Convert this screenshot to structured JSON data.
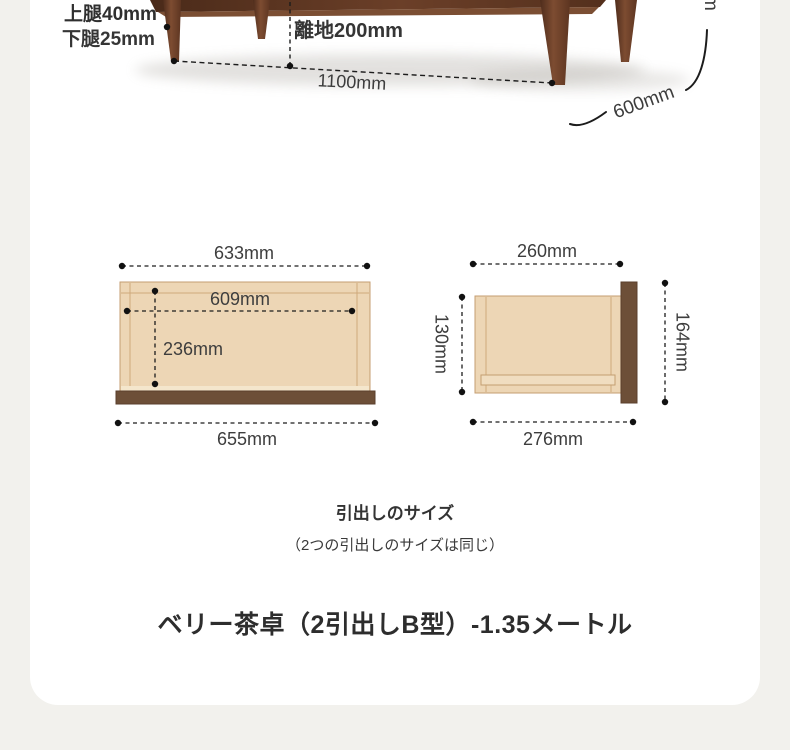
{
  "photo": {
    "upper_leg_label": "上腿40mm",
    "lower_leg_label": "下腿25mm",
    "ground_clearance_label": "離地200mm",
    "length_label": "1100mm",
    "depth_label": "600mm",
    "height_label_fragment": "m"
  },
  "drawer_front_view": {
    "top_width_label": "633mm",
    "inner_width_label": "609mm",
    "inner_height_label": "236mm",
    "bottom_width_label": "655mm"
  },
  "drawer_side_view": {
    "top_depth_label": "260mm",
    "left_height_label": "130mm",
    "right_height_label": "164mm",
    "bottom_depth_label": "276mm"
  },
  "captions": {
    "heading": "引出しのサイズ",
    "note": "（2つの引出しのサイズは同じ）"
  },
  "product_title": "ベリー茶卓（2引出しB型）-1.35メートル",
  "colors": {
    "page_background": "#f2f1ed",
    "card_background": "#ffffff",
    "drawer_fill": "#edd6b5",
    "drawer_outline": "#c49e71",
    "drawer_bottom_panel": "#6d4f38",
    "dimension_line": "#1c1c1c",
    "dimension_text": "#3d3d3d",
    "table_wood": "#6b4126"
  }
}
